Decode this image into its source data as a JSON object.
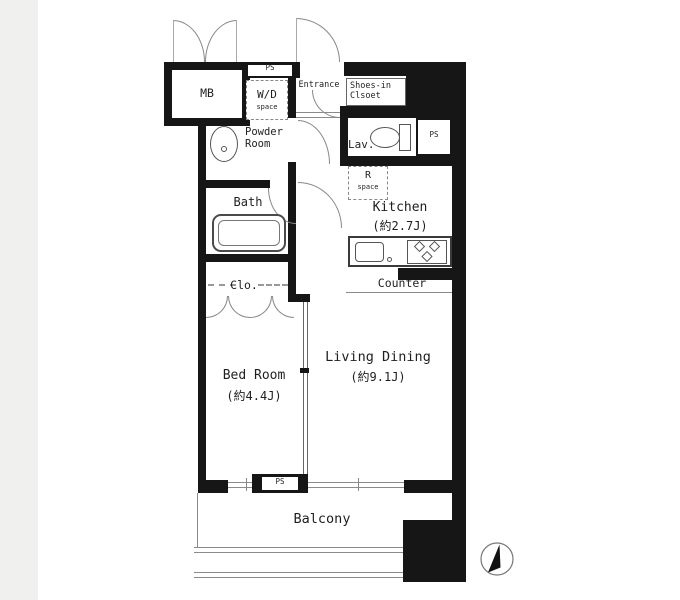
{
  "floorplan": {
    "mb": "MB",
    "ps": "PS",
    "wd": "W/D",
    "wd_sub": "space",
    "entrance": "Entrance",
    "shoes_line1": "Shoes-in",
    "shoes_line2": "Clsoet",
    "powder_line1": "Powder",
    "powder_line2": "Room",
    "lav": "Lav.",
    "r": "R",
    "r_sub": "space",
    "bath": "Bath",
    "kitchen": "Kitchen",
    "kitchen_size": "(約2.7J)",
    "counter": "Counter",
    "closet": "Clo.",
    "bedroom": "Bed Room",
    "bedroom_size": "(約4.4J)",
    "living": "Living Dining",
    "living_size": "(約9.1J)",
    "balcony": "Balcony"
  },
  "icons": {
    "compass": "north-arrow"
  },
  "colors": {
    "wall": "#161616",
    "line": "#8a8a8a",
    "background": "#ffffff",
    "page_margin": "#f0f0ee",
    "text": "#1f1f1f"
  }
}
